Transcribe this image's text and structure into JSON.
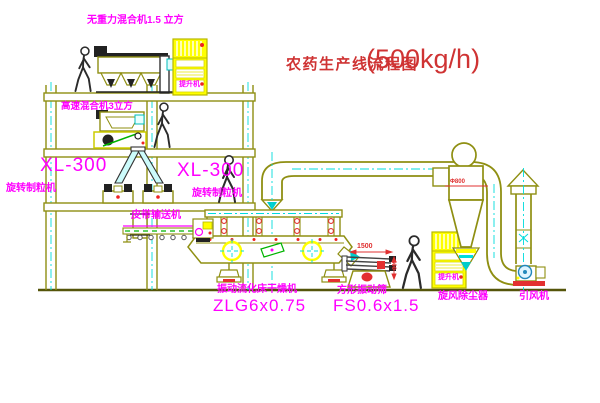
{
  "title": {
    "name": "农药生产线流程图",
    "capacity": "(500kg/h)"
  },
  "labels": {
    "top_mixer": "无重力混合机1.5 立方",
    "speed_mixer": "高速混合机3立方",
    "granulator_left": {
      "model": "XL-300",
      "name": "旋转制粒机"
    },
    "granulator_mid": {
      "model": "XL-300",
      "name": "旋转制粒机"
    },
    "belt_conveyor": "皮带输送机",
    "dryer": {
      "name": "振动流化床干燥机",
      "model": "ZLG6x0.75"
    },
    "sieve": {
      "name": "方形振动筛",
      "model": "FS0.6x1.5"
    },
    "cyclone": "旋风除尘器",
    "fan": "引风机",
    "elevator1": "提升机",
    "elevator2": "提升机"
  },
  "dimensions": {
    "sieve_length": "1500",
    "sieve_height": "600",
    "cyclone_dia": "Φ800"
  },
  "colors": {
    "line_olive": "#8f8f12",
    "label_magenta": "#ff00ff",
    "title_red": "#cf3333",
    "centerline_cyan": "#00dcdc",
    "fill_yellow": "#ffff00",
    "belt_green": "#00b400"
  }
}
